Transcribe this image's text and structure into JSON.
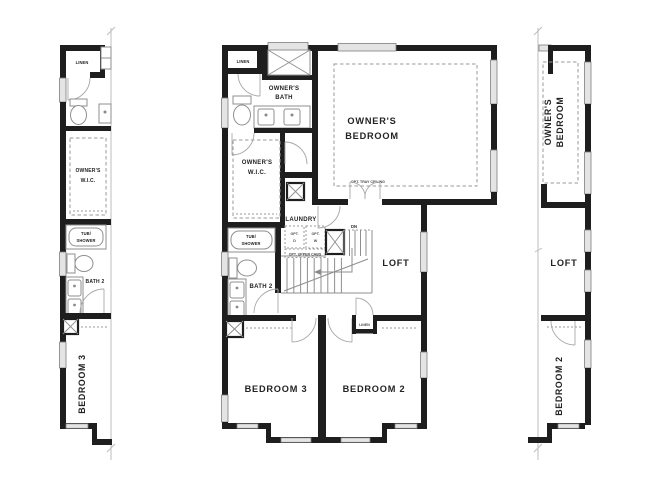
{
  "colors": {
    "wall": "#1e1e1e",
    "thin_line": "#8f8f8f",
    "dash_line": "#9a9a9a",
    "window_fill": "#e4e4e4",
    "text": "#232323",
    "background": "#ffffff"
  },
  "left_section": {
    "labels": {
      "linen": "LINEN",
      "wic_line1": "OWNER'S",
      "wic_line2": "W.I.C.",
      "tub_line1": "TUB/",
      "tub_line2": "SHOWER",
      "bath2": "BATH 2",
      "bedroom3": "BEDROOM 3"
    }
  },
  "center_section": {
    "labels": {
      "linen_top": "LINEN",
      "owners_bath_line1": "OWNER'S",
      "owners_bath_line2": "BATH",
      "owners_bedroom_line1": "OWNER'S",
      "owners_bedroom_line2": "BEDROOM",
      "opt_tray_ceiling": "OPT. TRAY CEILING",
      "wic_line1": "OWNER'S",
      "wic_line2": "W.I.C.",
      "laundry": "LAUNDRY",
      "opt_d_line1": "OPT.",
      "opt_d_line2": "D",
      "opt_w_line1": "OPT.",
      "opt_w_line2": "W",
      "opt_upper_cabs": "OPT. UPPER CABS",
      "dn": "DN",
      "loft": "LOFT",
      "tub_line1": "TUB/",
      "tub_line2": "SHOWER",
      "bath2": "BATH 2",
      "linen_hall": "LINEN",
      "bedroom3": "BEDROOM 3",
      "bedroom2": "BEDROOM 2"
    }
  },
  "right_section": {
    "labels": {
      "owners_bedroom_line1": "OWNER'S",
      "owners_bedroom_line2": "BEDROOM",
      "loft": "LOFT",
      "bedroom2": "BEDROOM 2"
    }
  }
}
